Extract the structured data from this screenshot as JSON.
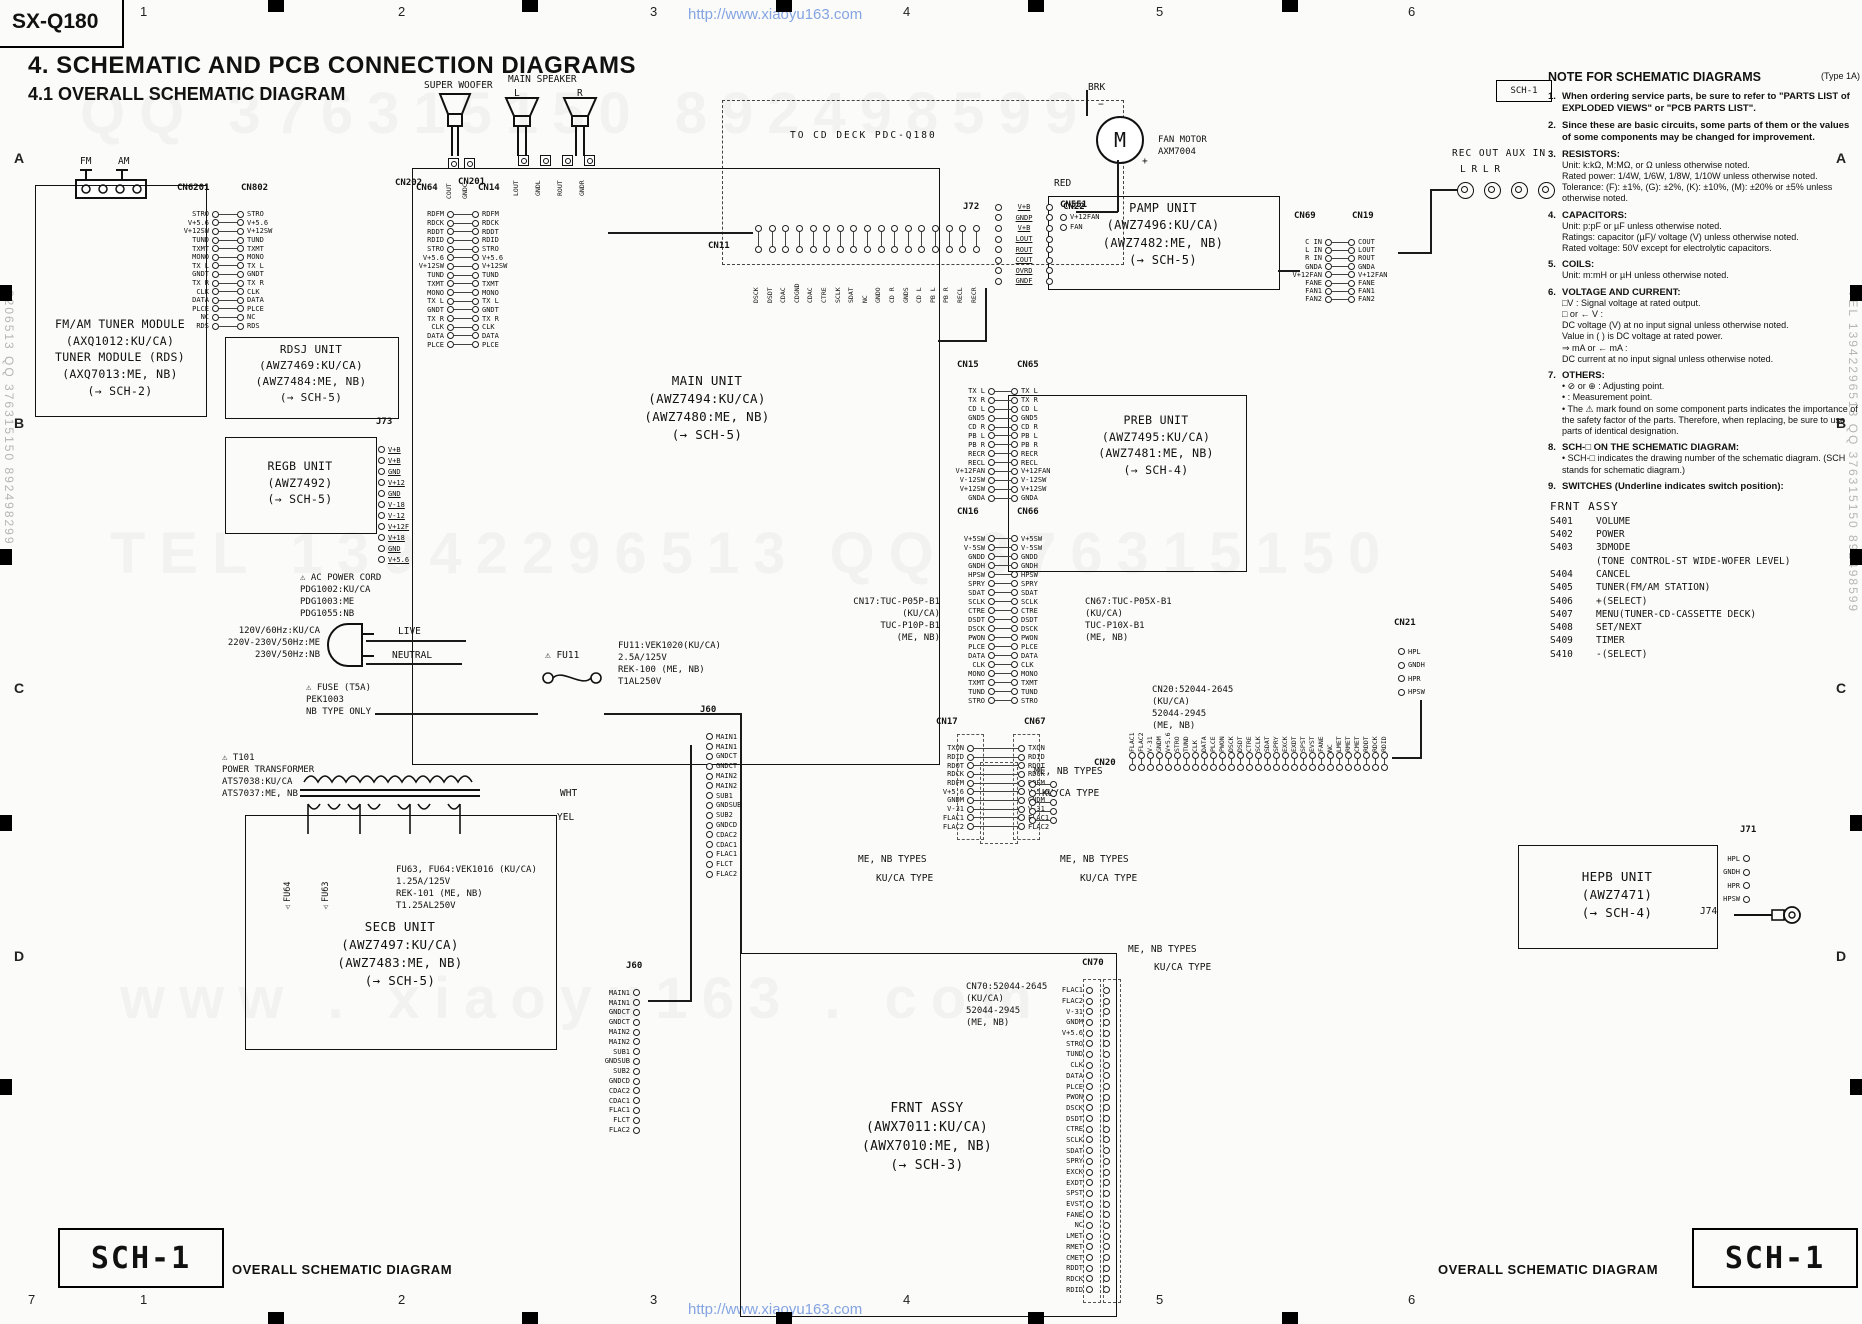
{
  "page": {
    "model": "SX-Q180",
    "title": "4. SCHEMATIC AND PCB CONNECTION DIAGRAMS",
    "subtitle": "4.1 OVERALL SCHEMATIC DIAGRAM",
    "watermark": "http://www.xiaoyu163.com",
    "sheet_label": "SCH-1",
    "sheet_caption": "OVERALL SCHEMATIC DIAGRAM",
    "grid_cols": [
      "1",
      "2",
      "3",
      "4",
      "5",
      "6"
    ],
    "grid_rows": [
      "A",
      "B",
      "C",
      "D"
    ],
    "corner_number": "7",
    "faint_watermarks": [
      "QQ  376315150   892498599",
      "TEL  13942296513    QQ  376315150",
      "www . xiaoyu163 . com"
    ],
    "edge_watermark_left": "2206513  QQ 376315150  892498299",
    "edge_watermark_right": "TEL 13942296513  QQ 376315150  892498599"
  },
  "units": {
    "fm_tuner": {
      "lines": [
        "FM/AM TUNER MODULE",
        "(AXQ1012:KU/CA)",
        "TUNER MODULE (RDS)",
        "(AXQ7013:ME, NB)",
        "(→ SCH-2)"
      ]
    },
    "rdsj": {
      "lines": [
        "RDSJ UNIT",
        "(AWZ7469:KU/CA)",
        "(AWZ7484:ME, NB)",
        "(→ SCH-5)"
      ]
    },
    "regb": {
      "lines": [
        "REGB UNIT",
        "(AWZ7492)",
        "(→ SCH-5)"
      ]
    },
    "main": {
      "lines": [
        "MAIN UNIT",
        "(AWZ7494:KU/CA)",
        "(AWZ7480:ME, NB)",
        "(→ SCH-5)"
      ]
    },
    "pamp": {
      "lines": [
        "PAMP UNIT",
        "(AWZ7496:KU/CA)",
        "(AWZ7482:ME, NB)",
        "(→ SCH-5)"
      ]
    },
    "preb": {
      "lines": [
        "PREB UNIT",
        "(AWZ7495:KU/CA)",
        "(AWZ7481:ME, NB)",
        "(→ SCH-4)"
      ]
    },
    "hepb": {
      "lines": [
        "HEPB UNIT",
        "(AWZ7471)",
        "(→ SCH-4)"
      ]
    },
    "frnt": {
      "lines": [
        "FRNT ASSY",
        "(AWX7011:KU/CA)",
        "(AWX7010:ME, NB)",
        "(→ SCH-3)"
      ]
    },
    "secb": {
      "lines": [
        "SECB UNIT",
        "(AWZ7497:KU/CA)",
        "(AWZ7483:ME, NB)",
        "(→ SCH-5)"
      ]
    }
  },
  "annotations": {
    "to_cd_deck": "TO CD DECK PDC-Q180",
    "super_woofer": "SUPER WOOFER",
    "main_speaker": "MAIN SPEAKER",
    "sp_l": "L",
    "sp_r": "R",
    "fm": "FM",
    "am": "AM",
    "fan_motor": "FAN MOTOR\nAXM7004",
    "brk": "BRK",
    "red": "RED",
    "motor_m": "M",
    "plus": "+",
    "minus": "−",
    "rec_aux": "REC OUT  AUX IN",
    "jack_labels": "L        R        L        R",
    "fu11": "⚠ FU11",
    "fu11_note": [
      "FU11:VEK1020(KU/CA)",
      "     2.5A/125V",
      "     REK-100 (ME, NB)",
      "     T1AL250V"
    ],
    "ac_cord": [
      "⚠ AC POWER CORD",
      "   PDG1002:KU/CA",
      "   PDG1003:ME",
      "   PDG1055:NB"
    ],
    "mains": [
      "120V/60Hz:KU/CA",
      "220V-230V/50Hz:ME",
      "230V/50Hz:NB"
    ],
    "live": "LIVE",
    "neutral": "NEUTRAL",
    "fuse_note": [
      "⚠ FUSE (T5A)",
      "   PEK1003",
      "   NB TYPE ONLY"
    ],
    "wht": "WHT",
    "yel": "YEL",
    "t101": [
      "⚠ T101",
      "POWER TRANSFORMER",
      "ATS7038:KU/CA",
      "ATS7037:ME, NB"
    ],
    "fu6364_note": [
      "FU63, FU64:VEK1016 (KU/CA)",
      "     1.25A/125V",
      "     REK-101 (ME, NB)",
      "     T1.25AL250V"
    ],
    "fu64": "⚠FU64",
    "fu63": "⚠FU63",
    "cn17_note": [
      "CN17:TUC-P05P-B1",
      "(KU/CA)",
      "TUC-P10P-B1",
      "(ME, NB)"
    ],
    "cn67_note": [
      "CN67:TUC-P05X-B1",
      "   (KU/CA)",
      "   TUC-P10X-B1",
      "   (ME, NB)"
    ],
    "cn20_note": [
      "CN20:52044-2645",
      "   (KU/CA)",
      "   52044-2945",
      "   (ME, NB)"
    ],
    "cn70_note": [
      "CN70:52044-2645",
      "   (KU/CA)",
      "   52044-2945",
      "   (ME, NB)"
    ],
    "me_nb_types": "ME, NB TYPES",
    "kuca_type": "KU/CA TYPE",
    "j74": "J74"
  },
  "connectors": {
    "cn6201": {
      "headers": [
        "CN6201",
        "CN802"
      ],
      "labels": [
        "STRO",
        "V+5.6",
        "V+12SW",
        "TUND",
        "TXMT",
        "MONO",
        "TX L",
        "GNDT",
        "TX R",
        "CLK",
        "DATA",
        "PLCE",
        "NC",
        "RDS"
      ]
    },
    "cn64": {
      "headers": [
        "CN64",
        "CN14"
      ],
      "labels": [
        "RDFM",
        "RDCK",
        "RDDT",
        "RDID",
        "STRO",
        "V+5.6",
        "V+12SW",
        "TUND",
        "TXMT",
        "MONO",
        "TX L",
        "GNDT",
        "TX R",
        "CLK",
        "DATA",
        "PLCE"
      ]
    },
    "cn15": {
      "headers": [
        "CN15",
        "CN65"
      ],
      "labels": [
        "TX L",
        "TX R",
        "CD L",
        "GND5",
        "CD R",
        "PB L",
        "PB R",
        "RECR",
        "RECL",
        "V+12FAN",
        "V-12SW",
        "V+12SW",
        "GNDA"
      ]
    },
    "cn16": {
      "headers": [
        "CN16",
        "CN66"
      ],
      "labels": [
        "V+5SW",
        "V-5SW",
        "GNDD",
        "GNDH",
        "HPSW",
        "SPRY",
        "SDAT",
        "SCLK",
        "CTRE",
        "DSDT",
        "DSCK",
        "PWON",
        "PLCE",
        "DATA",
        "CLK",
        "MONO",
        "TXMT",
        "TUND",
        "STRO"
      ]
    },
    "cn17": {
      "headers": [
        "CN17",
        "CN67"
      ],
      "labels": [
        "TXON",
        "RDID",
        "RDOT",
        "RDCK",
        "RDFM",
        "V+5.6",
        "GNDM",
        "V-31",
        "FLAC1",
        "FLAC2"
      ]
    },
    "cn17i": {
      "headers": [],
      "labels": [
        "",
        "",
        "",
        "",
        ""
      ]
    },
    "j72": {
      "headers": [
        "J72",
        "CN22"
      ],
      "labels": [
        "V+B",
        "GNDP",
        "V+B",
        "LOUT",
        "ROUT",
        "COUT",
        "OVRD",
        "GNDF"
      ]
    },
    "cn69": {
      "headers": [
        "CN69",
        "CN19"
      ],
      "left": [
        "C IN",
        "L IN",
        "R IN",
        "GNDA",
        "V+12FAN",
        "FANE",
        "FAN1",
        "FAN2"
      ],
      "right": [
        "COUT",
        "LOUT",
        "ROUT",
        "GNDA",
        "V+12FAN",
        "FANE",
        "FAN1",
        "FAN2"
      ]
    },
    "cn551": {
      "headers": [
        "CN551"
      ],
      "labels": [
        "V+12FAN",
        "FAN"
      ]
    },
    "cn21": {
      "headers": [
        "CN21"
      ],
      "labels": [
        "HPL",
        "GNDH",
        "HPR",
        "HPSW"
      ]
    },
    "j71": {
      "headers": [
        "J71"
      ],
      "labels": [
        "HPL",
        "GNDH",
        "HPR",
        "HPSW"
      ]
    },
    "j73": {
      "headers": [
        "J73"
      ],
      "labels": [
        "V+B",
        "V+B",
        "GND",
        "V+12",
        "GND",
        "V-18",
        "V-12",
        "V+12F",
        "V+18",
        "GND",
        "V+5.6"
      ]
    },
    "j60r": {
      "headers": [
        "J60"
      ],
      "labels": [
        "MAIN1",
        "MAIN1",
        "GNDCT",
        "GNDCT",
        "MAIN2",
        "MAIN2",
        "SUB1",
        "GNDSUB",
        "SUB2",
        "GNDCD",
        "CDAC2",
        "CDAC1",
        "FLAC1",
        "FLCT",
        "FLAC2"
      ]
    },
    "j60l": {
      "headers": [
        "J60"
      ],
      "labels": [
        "MAIN1",
        "MAIN1",
        "GNDCT",
        "GNDCT",
        "MAIN2",
        "MAIN2",
        "SUB1",
        "GNDSUB",
        "SUB2",
        "GNDCD",
        "CDAC2",
        "CDAC1",
        "FLAC1",
        "FLCT",
        "FLAC2"
      ]
    },
    "cn70": {
      "headers": [
        "CN70"
      ],
      "labels": [
        "FLAC1",
        "FLAC2",
        "V-31",
        "GNDM",
        "V+5.6",
        "STRO",
        "TUND",
        "CLK",
        "DATA",
        "PLCE",
        "PWON",
        "DSCK",
        "DSDT",
        "CTRE",
        "SCLK",
        "SDAT",
        "SPRY",
        "EXCK",
        "EXDT",
        "SPST",
        "EVST",
        "FANE",
        "NC",
        "LMET",
        "RMET",
        "CMET",
        "RDDT",
        "RDCK",
        "RDID"
      ]
    }
  },
  "hconnectors": {
    "cn202": {
      "header": "CN202",
      "labels": [
        "COUT",
        "GNDC"
      ]
    },
    "cn201": {
      "header": "CN201",
      "labels": [
        "LOUT",
        "GNDL",
        "ROUT",
        "GNDR"
      ]
    },
    "cn11": {
      "header": "CN11",
      "labels": [
        "DSCK",
        "DSDT",
        "CDAC",
        "CDGND",
        "CDAC",
        "CTRE",
        "SCLK",
        "SDAT",
        "NC",
        "GNDO",
        "CD R",
        "GNDS",
        "CD L",
        "PB L",
        "PB R",
        "RECL",
        "RECR"
      ]
    },
    "cn20": {
      "header": "CN20",
      "labels": [
        "FLAC1",
        "FLAC2",
        "V-31",
        "GNDM",
        "V+5.6",
        "STRO",
        "TUND",
        "CLK",
        "DATA",
        "PLCE",
        "PWON",
        "DSCK",
        "DSDT",
        "CTRE",
        "SCLK",
        "SDAT",
        "SPRY",
        "EXCK",
        "EXDT",
        "SPST",
        "EVST",
        "FANE",
        "NC",
        "LMET",
        "RMET",
        "CMET",
        "RDDT",
        "RDCK",
        "RDID"
      ]
    }
  },
  "notes": {
    "title": "NOTE FOR SCHEMATIC DIAGRAMS",
    "type_label": "(Type 1A)",
    "items": [
      {
        "num": "1.",
        "bold": true,
        "text": "When ordering service parts, be sure to refer to \"PARTS LIST of EXPLODED VIEWS\" or \"PCB PARTS LIST\"."
      },
      {
        "num": "2.",
        "bold": true,
        "text": "Since these are basic circuits, some parts of them or the values of some components may be changed for improvement."
      },
      {
        "num": "3.",
        "head": "RESISTORS:",
        "lines": [
          "Unit: k:kΩ, M:MΩ, or Ω unless otherwise noted.",
          "Rated power: 1/4W, 1/6W, 1/8W, 1/10W unless otherwise noted.",
          "Tolerance: (F): ±1%, (G): ±2%, (K): ±10%, (M): ±20% or ±5% unless otherwise noted."
        ]
      },
      {
        "num": "4.",
        "head": "CAPACITORS:",
        "lines": [
          "Unit: p:pF or µF unless otherwise noted.",
          "Ratings: capacitor (µF)/ voltage (V) unless otherwise noted.",
          "Rated voltage: 50V except for electrolytic capacitors."
        ]
      },
      {
        "num": "5.",
        "head": "COILS:",
        "lines": [
          "Unit: m:mH or µH unless otherwise noted."
        ]
      },
      {
        "num": "6.",
        "head": "VOLTAGE AND CURRENT:",
        "lines": [
          "□V : Signal voltage at rated output.",
          "□ or ← V :",
          "DC voltage (V) at no input signal unless otherwise noted.",
          "Value in (   ) is DC voltage at rated power.",
          "⇒ mA or ← mA :",
          "DC current at no input signal unless otherwise noted."
        ]
      },
      {
        "num": "7.",
        "head": "OTHERS:",
        "lines": [
          "• ⊘ or ⊕ : Adjusting point.",
          "•    : Measurement point.",
          "• The ⚠ mark found on some component parts indicates the importance of the safety factor of the parts. Therefore, when replacing, be sure to use parts of identical designation."
        ]
      },
      {
        "num": "8.",
        "head": "SCH-□ ON THE SCHEMATIC DIAGRAM:",
        "lines": [
          "• SCH-□ indicates the drawing number of the schematic diagram. (SCH stands for schematic diagram.)"
        ]
      },
      {
        "num": "9.",
        "head": "SWITCHES (Underline indicates switch position):",
        "lines": []
      }
    ],
    "switches_title": "FRNT ASSY",
    "switches": [
      [
        "S401",
        "VOLUME"
      ],
      [
        "S402",
        "POWER"
      ],
      [
        "S403",
        "3DMODE"
      ],
      [
        "",
        "(TONE CONTROL-ST WIDE-WOFER LEVEL)"
      ],
      [
        "S404",
        "CANCEL"
      ],
      [
        "S405",
        "TUNER(FM/AM STATION)"
      ],
      [
        "S406",
        "+(SELECT)"
      ],
      [
        "S407",
        "MENU(TUNER-CD-CASSETTE DECK)"
      ],
      [
        "S408",
        "SET/NEXT"
      ],
      [
        "S409",
        "TIMER"
      ],
      [
        "S410",
        "-(SELECT)"
      ]
    ]
  }
}
